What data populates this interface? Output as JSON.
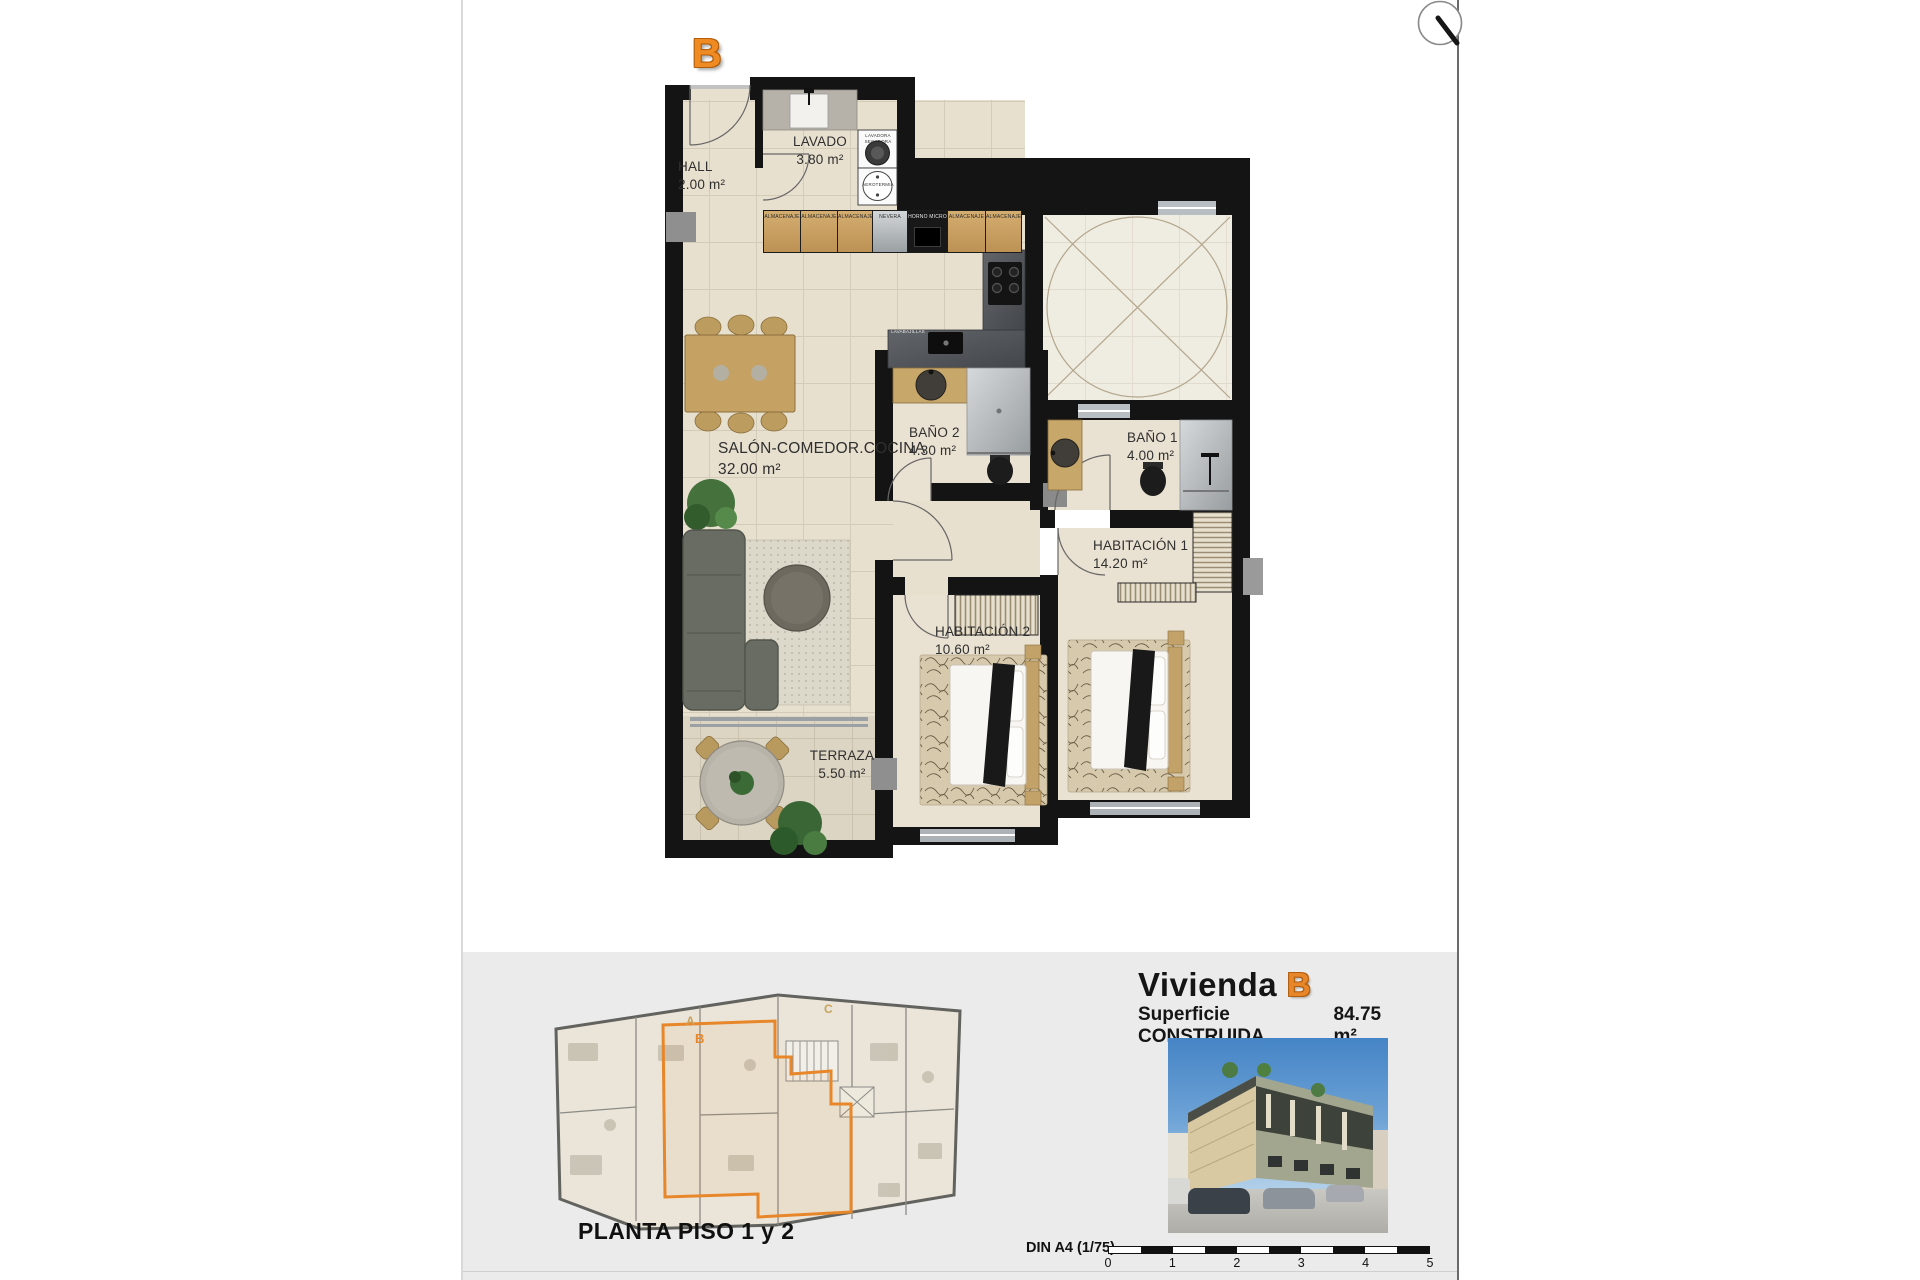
{
  "plan": {
    "unit_letter": "B",
    "rooms": [
      {
        "name": "HALL",
        "area": "2.00 m²"
      },
      {
        "name": "LAVADO",
        "area": "3.80 m²"
      },
      {
        "name": "SALÓN-COMEDOR.COCINA",
        "area": "32.00 m²"
      },
      {
        "name": "BAÑO 2",
        "area": "4.30 m²"
      },
      {
        "name": "BAÑO 1",
        "area": "4.00 m²"
      },
      {
        "name": "HABITACIÓN 1",
        "area": "14.20 m²"
      },
      {
        "name": "HABITACIÓN 2",
        "area": "10.60 m²"
      },
      {
        "name": "TERRAZA",
        "area": "5.50 m²"
      }
    ],
    "kitchen_cabinets": [
      "ALMACENAJE",
      "ALMACENAJE",
      "ALMACENAJE",
      "NEVERA",
      "HORNO MICRO",
      "ALMACENAJE",
      "ALMACENAJE"
    ],
    "appliances": {
      "washer_line1": "LAVADORA",
      "washer_line2": "SECADORA",
      "aerothermal": "AEROTERMIA",
      "dishwasher": "LAVABAJILLAS"
    }
  },
  "footer": {
    "site_caption": "PLANTA PISO 1 y 2",
    "unit_title_prefix": "Vivienda",
    "unit_title_letter": "B",
    "surface_label": "Superficie CONSTRUIDA",
    "surface_value": "84.75 m²",
    "scale_label": "DIN A4 (1/75)",
    "scale_ticks": [
      "0",
      "1",
      "2",
      "3",
      "4",
      "5"
    ],
    "site_letters": {
      "a": "A",
      "b": "B",
      "c": "C"
    }
  },
  "colors": {
    "accent_orange": "#E8862A",
    "wall_black": "#141414",
    "floor_beige": "#E7DFCE",
    "wood": "#C8A76B",
    "band_gray": "#EBEBEB"
  }
}
